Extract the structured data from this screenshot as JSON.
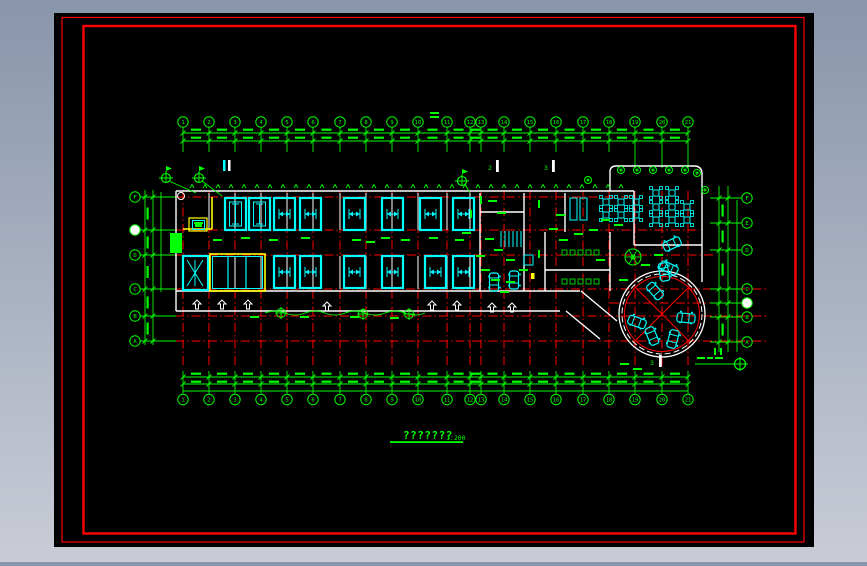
{
  "desktop": {
    "gradient_top": "#8995ab",
    "gradient_bottom": "#c9ccd6"
  },
  "sheet": {
    "background": "#000000",
    "border_color": "#ff0000"
  },
  "palette": {
    "green": "#00ff00",
    "cyan": "#00ffff",
    "yellow": "#ffff00",
    "white": "#ffffff",
    "red": "#ff0000"
  },
  "drawing": {
    "title": "???????",
    "scale_label": "1:200",
    "grid_axes": {
      "horizontal": [
        "1",
        "2",
        "3",
        "4",
        "5",
        "6",
        "7",
        "8",
        "9",
        "10",
        "11",
        "12",
        "13",
        "14",
        "15",
        "16",
        "17",
        "18",
        "19",
        "20",
        "21"
      ],
      "left_vertical": [
        "F",
        "",
        "D",
        "C",
        "B",
        "A"
      ],
      "right_vertical": [
        "F",
        "E",
        "D",
        "C",
        "",
        "B",
        "A"
      ]
    },
    "section_markers": [
      "2",
      "3",
      "3"
    ],
    "symbols": {
      "survey_marker": "circle-cross-flag",
      "benchmark": "circle-cross",
      "entrance_arrow": "hollow-up-arrow",
      "car": "rounded-rect-car",
      "dining_table": "square-table-four-chairs",
      "tree": "circle-scribble"
    }
  }
}
